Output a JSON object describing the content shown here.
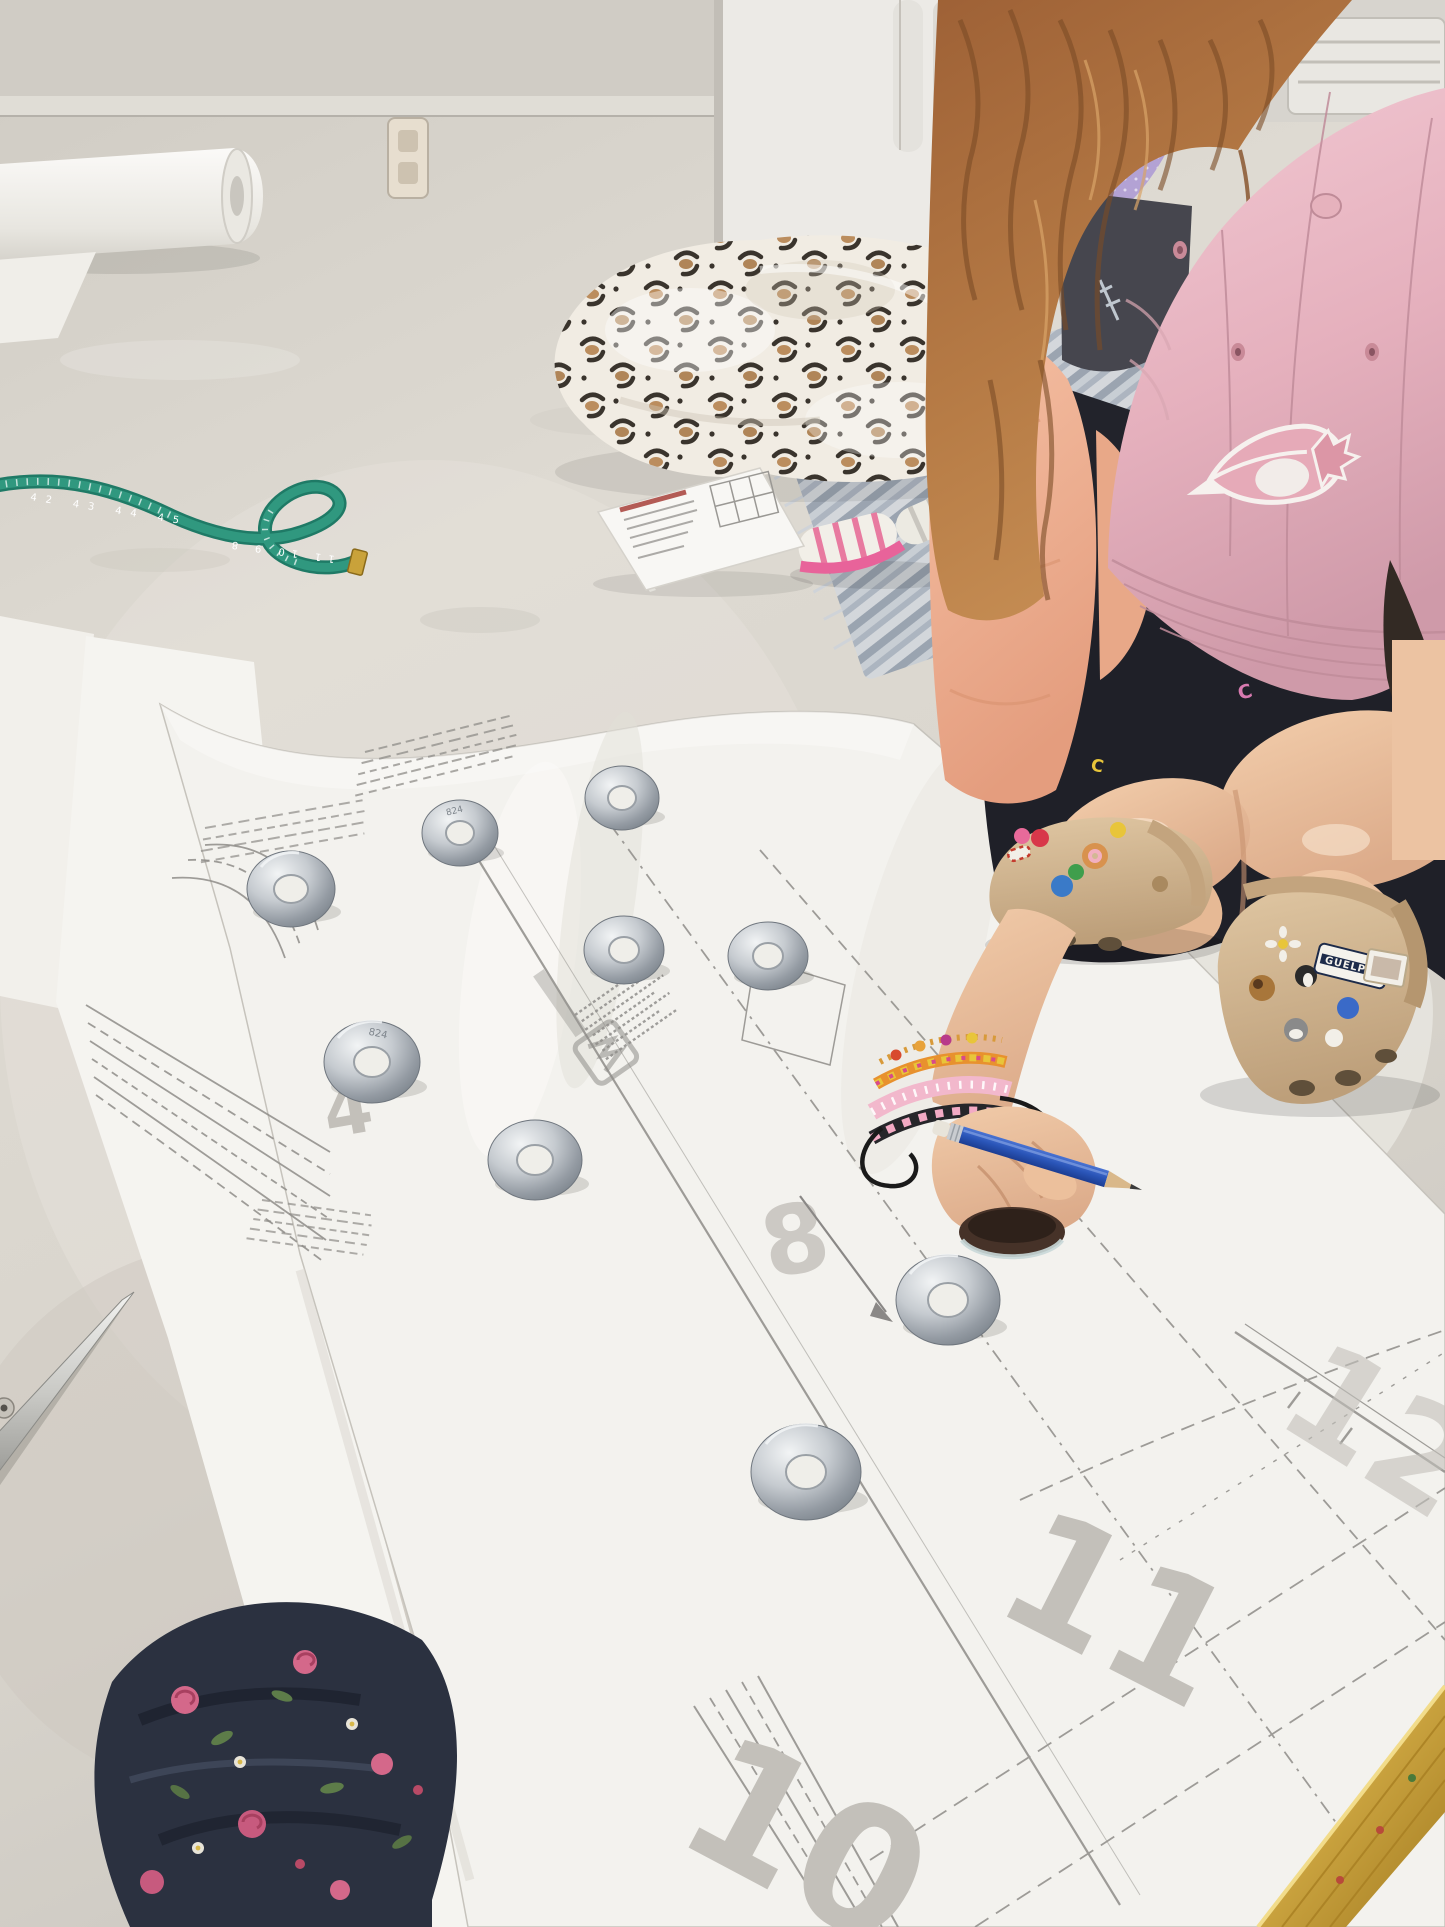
{
  "scene": {
    "description": "Photo: a child in a pink Blue Jays cap crouches on a white painted floor, tracing a large paper sewing pattern weighted down with metal washers; a second child sits on a striped rug in the background."
  },
  "labels": {
    "pattern_numbers": {
      "n4": "4",
      "n8": "8",
      "n10": "10",
      "n11": "11",
      "n12": "12"
    },
    "washer_stamp": "824",
    "charm_badge": "GUELPH",
    "shorts_logo_letter": "C",
    "tape_numbers_upper": "42 43 44 45",
    "tape_numbers_lower": "11 10 9 8"
  },
  "colors": {
    "floor": "#d8d4cc",
    "pattern_paper": "#f3f2ee",
    "pattern_ink": "#8f8d89",
    "faint_number_gray": "#c3c0ba",
    "cap_pink": "#e9bac6",
    "hair_auburn": "#ab6d3f",
    "tape_measure_teal": "#2a8f78",
    "pencil_blue": "#2a55b8",
    "croc_tan": "#d2b894",
    "shorts_navy": "#23242c",
    "floral_fabric_navy": "#2b3140",
    "gold_trim": "#c9a23e",
    "washer_steel": "#a7adb3"
  },
  "objects": {
    "washer_count": 9,
    "items": [
      "sewing pattern paper",
      "metal washers",
      "blue pencil",
      "instruction booklet",
      "teal tape measure",
      "fabric scissors",
      "leopard print blanket",
      "floral fabric",
      "gold trim fabric",
      "tan crocs with charms",
      "striped rug"
    ]
  }
}
